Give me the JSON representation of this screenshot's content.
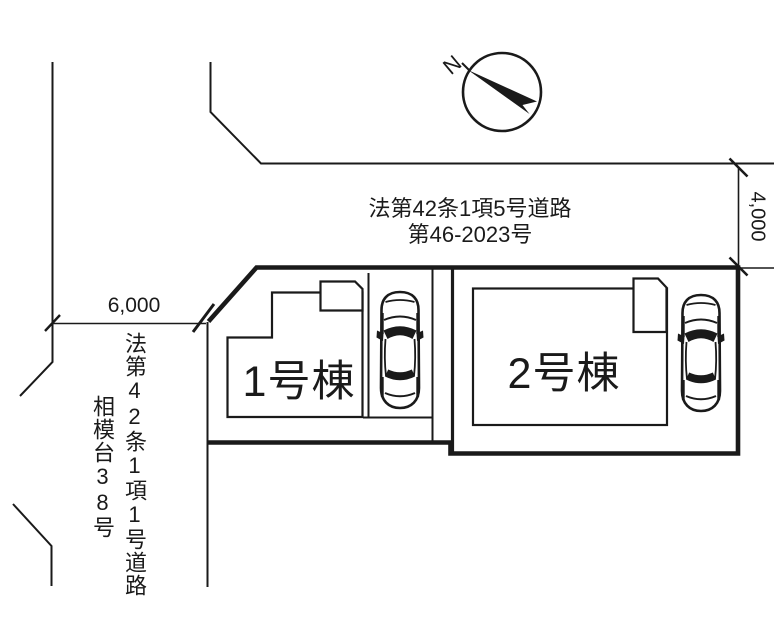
{
  "diagram": {
    "compass_label": "N",
    "north_road": {
      "label_line1": "法第42条1項5号道路",
      "label_line2": "第46-2023号",
      "width_dim": "4,000"
    },
    "west_road": {
      "label_line1": "法第42条1項1号道路",
      "label_line2": "相模台38号",
      "width_dim": "6,000"
    },
    "buildings": [
      {
        "label": "1号棟"
      },
      {
        "label": "2号棟"
      }
    ],
    "colors": {
      "ink": "#1a1a1a",
      "background": "#ffffff"
    }
  }
}
